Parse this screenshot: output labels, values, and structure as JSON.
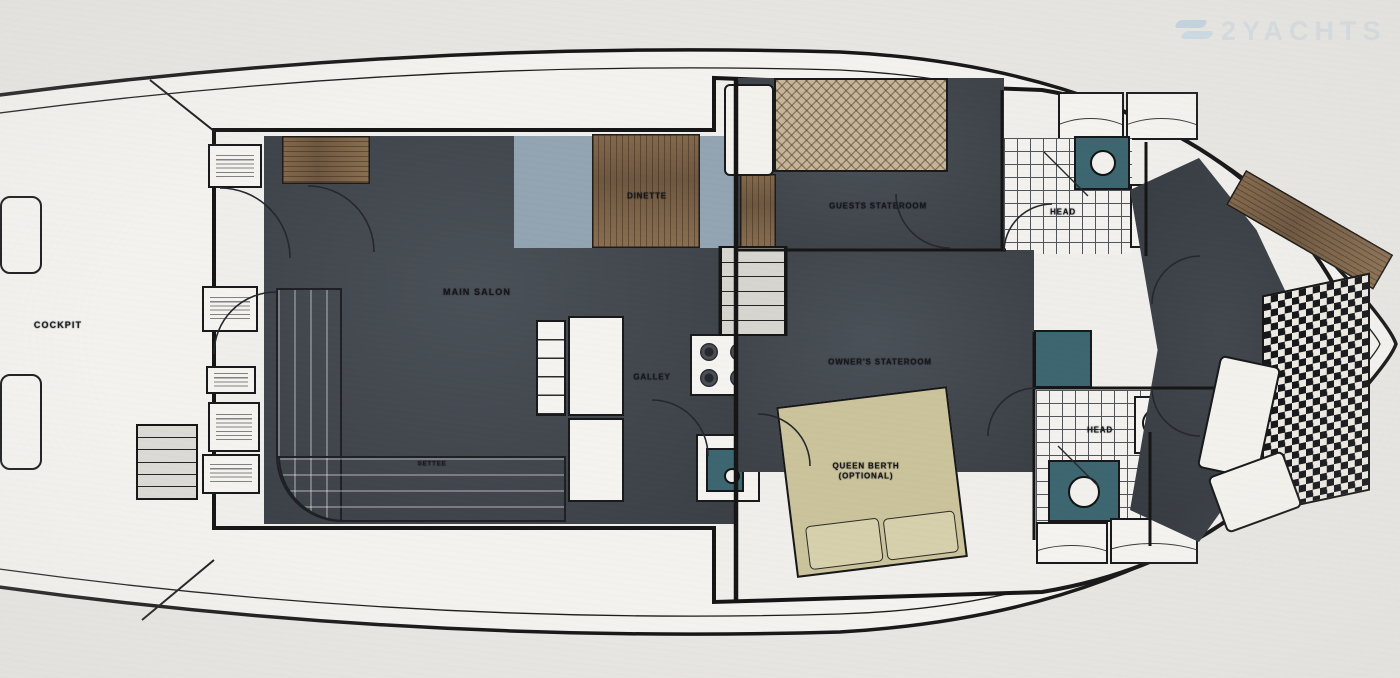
{
  "watermark": {
    "brand": "2YACHTS"
  },
  "labels": {
    "cockpit": "COCKPIT",
    "salon": "MAIN SALON",
    "dinette": "DINETTE",
    "galley": "GALLEY",
    "settee": "SETTEE",
    "guest_stateroom": "GUESTS STATEROOM",
    "owners_stateroom": "OWNER'S STATEROOM",
    "head_forward": "HEAD",
    "head_aft": "HEAD",
    "queen_berth_line1": "QUEEN BERTH",
    "queen_berth_line2": "(OPTIONAL)"
  },
  "colors": {
    "paper": "#e9e8e4",
    "hull_fill": "#f5f4f1",
    "outline": "#141414",
    "floor_dark": "#41464d",
    "floor_blue": "#93a5b4",
    "wood": "#7a6248",
    "berth_tan": "#cdc49c",
    "fixture_teal": "#3c6570",
    "settee_gray": "#b9bfc4",
    "watermark_blue": "#ccd8e1"
  }
}
